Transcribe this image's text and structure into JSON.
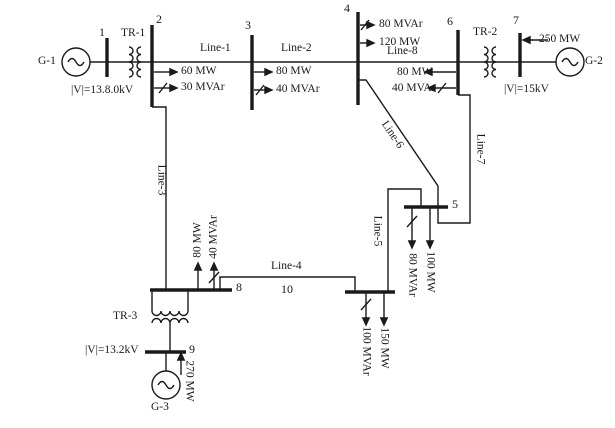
{
  "figure": {
    "type": "power-system-one-line-diagram",
    "buses": {
      "b1": {
        "number": "1"
      },
      "b2": {
        "number": "2",
        "load_mw": "60 MW",
        "load_mvar": "30 MVAr"
      },
      "b3": {
        "number": "3",
        "load_mw": "80 MW",
        "load_mvar": "40 MVAr"
      },
      "b4": {
        "number": "4",
        "load_mw": "120 MW",
        "load_mvar": "80 MVAr"
      },
      "b5": {
        "number": "5",
        "load_mw": "100 MW",
        "load_mvar": "80 MVAr"
      },
      "b6": {
        "number": "6",
        "load_mw": "80 MW",
        "load_mvar": "40 MVAr"
      },
      "b7": {
        "number": "7"
      },
      "b8": {
        "number": "8",
        "load_mw": "80 MW",
        "load_mvar": "40 MVAr"
      },
      "b9": {
        "number": "9"
      },
      "b10": {
        "number": "10",
        "load_mw": "150 MW",
        "load_mvar": "100 MVAr"
      }
    },
    "generators": {
      "g1": {
        "name": "G-1",
        "voltage": "|V|=13.8.0kV"
      },
      "g2": {
        "name": "G-2",
        "voltage": "|V|=15kV",
        "power": "250 MW"
      },
      "g3": {
        "name": "G-3",
        "voltage": "|V|=13.2kV",
        "power": "270 MW"
      }
    },
    "transformers": {
      "tr1": {
        "name": "TR-1"
      },
      "tr2": {
        "name": "TR-2"
      },
      "tr3": {
        "name": "TR-3"
      }
    },
    "lines": {
      "l1": {
        "name": "Line-1"
      },
      "l2": {
        "name": "Line-2"
      },
      "l3": {
        "name": "Line-3"
      },
      "l4": {
        "name": "Line-4"
      },
      "l5": {
        "name": "Line-5"
      },
      "l6": {
        "name": "Line-6"
      },
      "l7": {
        "name": "Line-7"
      },
      "l8": {
        "name": "Line-8"
      }
    },
    "colors": {
      "ink": "#1a1a1a",
      "background": "#ffffff"
    }
  }
}
